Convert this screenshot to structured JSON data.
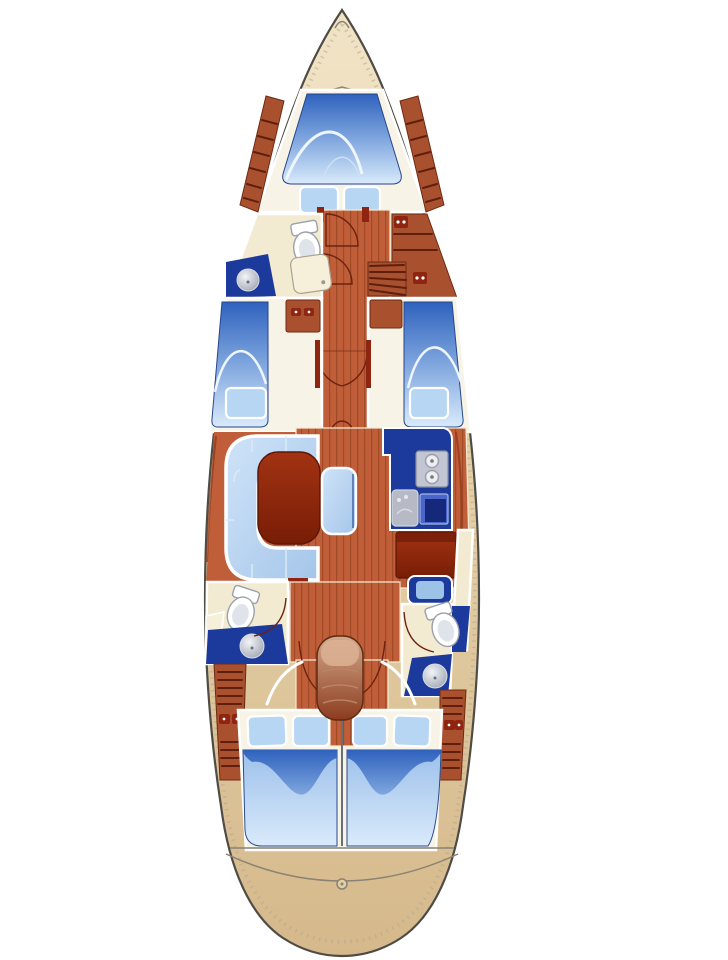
{
  "diagram": {
    "type": "sailing-yacht-interior-floor-plan",
    "orientation": "bow-up",
    "areas": [
      "bow-deck-anchor-well",
      "forward-cabin-v-berth",
      "forward-head-with-shower",
      "port-guest-cabin",
      "starboard-guest-cabin",
      "saloon-u-settee-with-table-and-bench",
      "galley-with-stove-and-sinks",
      "navigation-station",
      "port-aft-head",
      "starboard-aft-head",
      "companionway-helm-seat-cockpit",
      "aft-double-berths",
      "stern-deck"
    ],
    "icons": [
      "toilet-icon",
      "round-sink-icon",
      "two-burner-stove-icon",
      "square-sink-icon",
      "door-swing-arc-icon",
      "locker-slats-icon",
      "helm-seat-icon",
      "pillow-icon",
      "mattress-icon"
    ]
  },
  "counts": {
    "toilets": 3,
    "round_sinks": 3,
    "stove_burners": 2,
    "pillows_forward_cabin": 2,
    "pillows_guest_cabins": 2,
    "pillows_aft_berths": 4,
    "double_berths_aft": 2
  },
  "colors": {
    "background": "#ffffff",
    "hull_outline": "#4f4c46",
    "deck_light": "#f1e4c6",
    "deck_mid": "#e3cda4",
    "deck_dark": "#d5b98c",
    "floor_terracotta": "#bf5e38",
    "plank_line": "#a04a26",
    "wood_brown": "#a9512f",
    "wood_slat": "#5f1f0c",
    "wood_edge": "#6e2a14",
    "maroon": "#8f2410",
    "maroon_dark": "#5e1608",
    "navy": "#1c3a9c",
    "navy_dark": "#16287a",
    "mattress_deep": "#2f62be",
    "mattress_mid": "#7fa6de",
    "mattress_pale": "#d9eafb",
    "pillow_blue": "#b7d6f3",
    "settee_light": "#cfe3f8",
    "settee_deep": "#a5c6ea",
    "room_cream": "#f2ebd2",
    "room_white": "#f7f3e6",
    "shower_cream": "#f6efda",
    "steel_gray": "#b6bac6",
    "helm_light": "#d4a98b",
    "helm_dark": "#8c3c20",
    "line_dark": "#6b2210",
    "stern_line": "#8a8274",
    "sink_blue_light": "#4a66cc"
  }
}
